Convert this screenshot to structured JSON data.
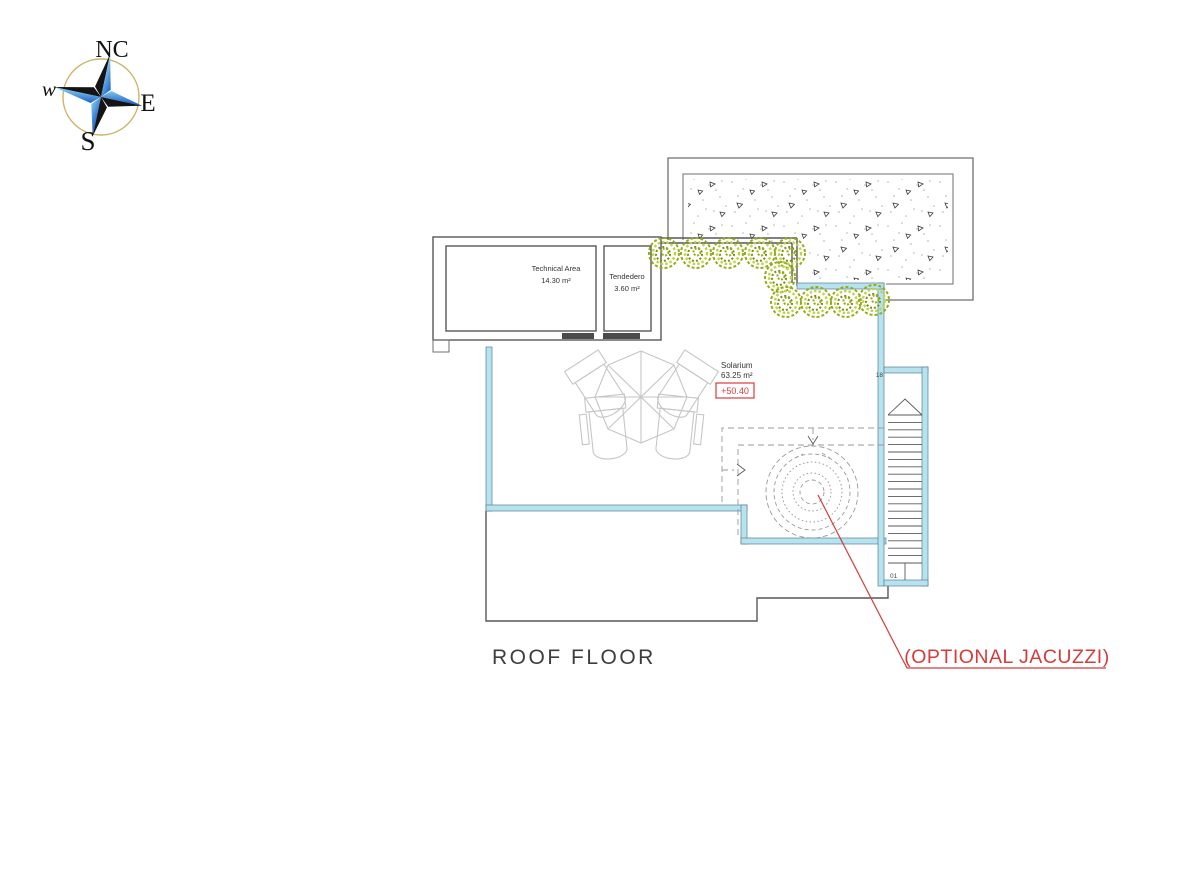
{
  "compass": {
    "north_label": "NC",
    "east_label": "E",
    "south_label": "S",
    "west_label": "w"
  },
  "plan": {
    "title": "ROOF FLOOR",
    "rooms": {
      "technical_area": {
        "name": "Technical Area",
        "area": "14.30 m²"
      },
      "tendedero": {
        "name": "Tendedero",
        "area": "3.60 m²"
      },
      "solarium": {
        "name": "Solarium",
        "area": "63.25 m²",
        "elevation": "+50.40"
      }
    },
    "stairs": {
      "top_step": "18",
      "bottom_step": "01"
    },
    "annotation": {
      "jacuzzi": "(OPTIONAL JACUZZI)"
    }
  },
  "colors": {
    "outline": "#6f6f6f",
    "wall_dark": "#4a4a4a",
    "glass_balustrade": "#b5e3f0",
    "accent_red": "#d43c3c",
    "furniture_gray": "#c6c6c6",
    "bush_green": "#93ad17",
    "bush_green_light": "#bdd348",
    "bush_green_dark": "#75910c",
    "compass_ring": "#ccb468"
  }
}
